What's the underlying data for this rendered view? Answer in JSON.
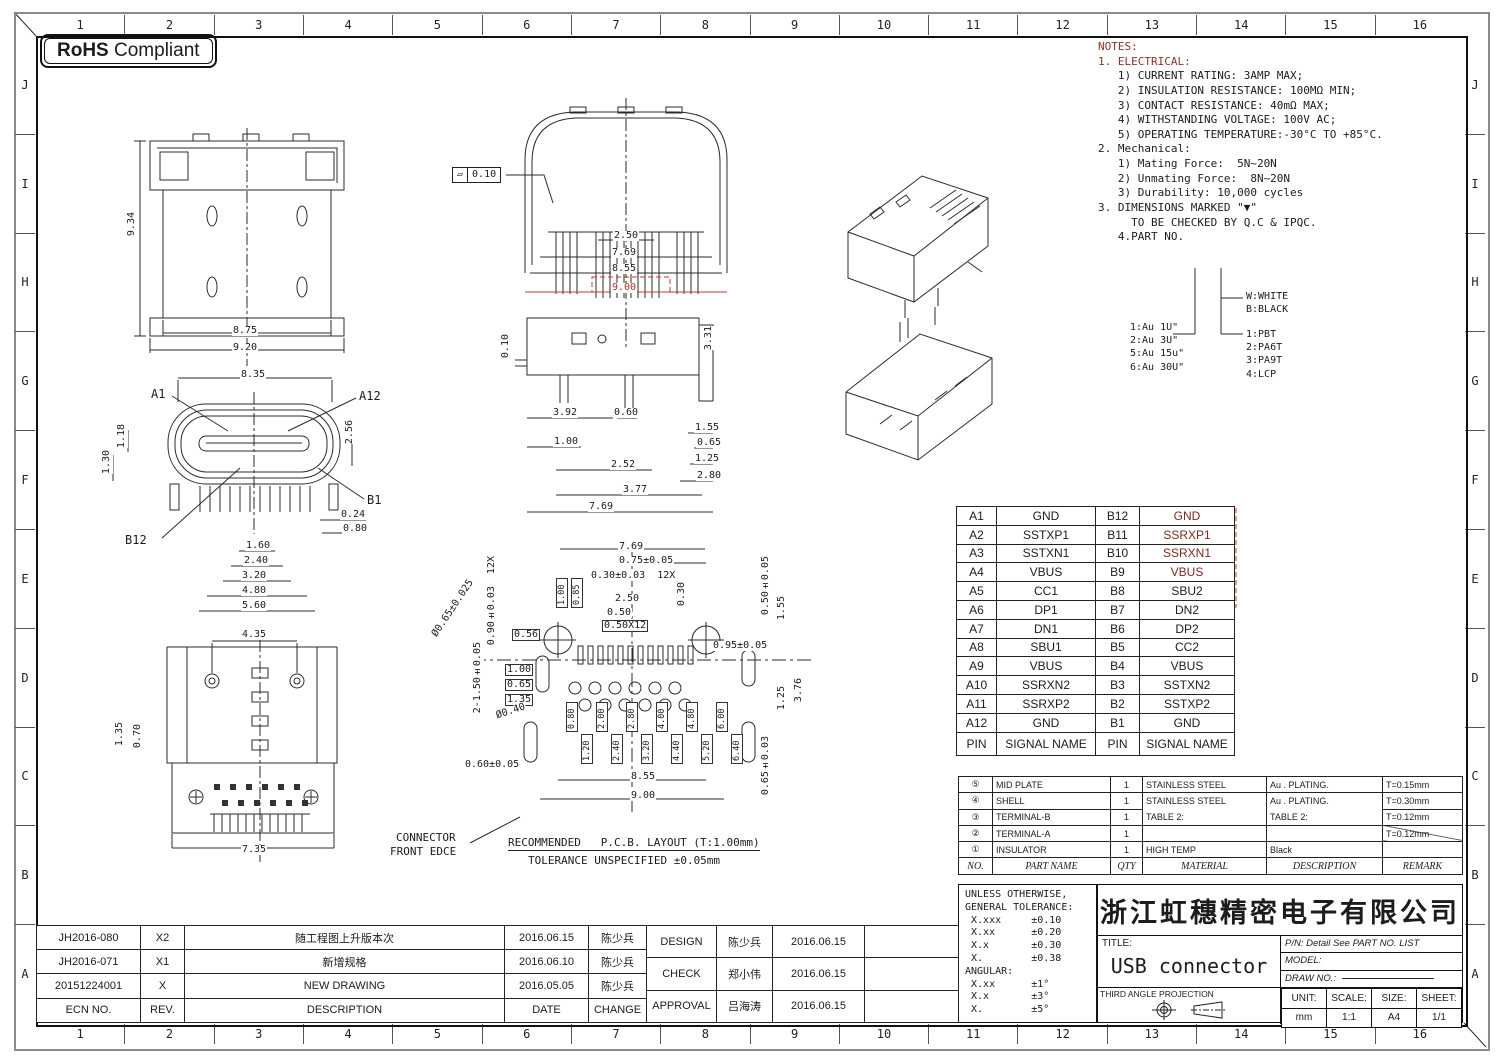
{
  "sheet": {
    "badge_bold": "RoHS",
    "badge_rest": "Compliant",
    "zone_cols": [
      "1",
      "2",
      "3",
      "4",
      "5",
      "6",
      "7",
      "8",
      "9",
      "10",
      "11",
      "12",
      "13",
      "14",
      "15",
      "16"
    ],
    "zone_rows": [
      "J",
      "I",
      "H",
      "G",
      "F",
      "E",
      "D",
      "C",
      "B",
      "A"
    ]
  },
  "notes": {
    "lines": [
      "NOTES:",
      "1. ELECTRICAL:",
      "   1) CURRENT RATING: 3AMP MAX;",
      "   2) INSULATION RESISTANCE: 100MΩ MIN;",
      "   3) CONTACT RESISTANCE: 40mΩ MAX;",
      "   4) WITHSTANDING VOLTAGE: 100V AC;",
      "   5) OPERATING TEMPERATURE:-30°C TO +85°C.",
      "2. Mechanical:",
      "   1) Mating Force:  5N~20N",
      "   2) Unmating Force:  8N~20N",
      "   3) Durability: 10,000 cycles",
      "3. DIMENSIONS MARKED \"▼\"",
      "     TO BE CHECKED BY Q.C & IPQC.",
      "",
      "   4.PART NO."
    ]
  },
  "part_no_legend": {
    "au_options": [
      "1:Au 1U\"",
      "2:Au 3U\"",
      "5:Au 15u\"",
      "6:Au 30U\""
    ],
    "color_options": [
      "W:WHITE",
      "B:BLACK"
    ],
    "material_options": [
      "1:PBT",
      "2:PA6T",
      "3:PA9T",
      "4:LCP"
    ]
  },
  "pin_table": {
    "rows": [
      [
        "A1",
        "GND",
        "B12",
        "GND"
      ],
      [
        "A2",
        "SSTXP1",
        "B11",
        "SSRXP1"
      ],
      [
        "A3",
        "SSTXN1",
        "B10",
        "SSRXN1"
      ],
      [
        "A4",
        "VBUS",
        "B9",
        "VBUS"
      ],
      [
        "A5",
        "CC1",
        "B8",
        "SBU2"
      ],
      [
        "A6",
        "DP1",
        "B7",
        "DN2"
      ],
      [
        "A7",
        "DN1",
        "B6",
        "DP2"
      ],
      [
        "A8",
        "SBU1",
        "B5",
        "CC2"
      ],
      [
        "A9",
        "VBUS",
        "B4",
        "VBUS"
      ],
      [
        "A10",
        "SSRXN2",
        "B3",
        "SSTXN2"
      ],
      [
        "A11",
        "SSRXP2",
        "B2",
        "SSTXP2"
      ],
      [
        "A12",
        "GND",
        "B1",
        "GND"
      ],
      [
        "PIN",
        "SIGNAL NAME",
        "PIN",
        "SIGNAL NAME"
      ]
    ]
  },
  "materials_table": {
    "rows": [
      [
        "⑤",
        "MID PLATE",
        "1",
        "STAINLESS STEEL",
        "Au . PLATING.",
        "T=0.15mm"
      ],
      [
        "④",
        "SHELL",
        "1",
        "STAINLESS STEEL",
        "Au . PLATING.",
        "T=0.30mm"
      ],
      [
        "③",
        "TERMINAL-B",
        "1",
        "TABLE 2:",
        "TABLE 2:",
        "T=0.12mm"
      ],
      [
        "②",
        "TERMINAL-A",
        "1",
        "",
        "",
        "T=0.12mm"
      ],
      [
        "①",
        "INSULATOR",
        "1",
        "HIGH TEMP",
        "Black",
        ""
      ],
      [
        "NO.",
        "PART NAME",
        "QTY",
        "MATERIAL",
        "DESCRIPTION",
        "REMARK"
      ]
    ]
  },
  "tolerance_block": {
    "lines": [
      "UNLESS OTHERWISE,",
      "GENERAL TOLERANCE:",
      " X.xxx     ±0.10",
      " X.xx      ±0.20",
      " X.x       ±0.30",
      " X.        ±0.38",
      "ANGULAR:",
      " X.xx      ±1°",
      " X.x       ±3°",
      " X.        ±5°"
    ]
  },
  "title_block": {
    "company": "浙江虹穗精密电子有限公司",
    "title_label": "TITLE:",
    "title_value": "USB connector",
    "pn": "P/N: Detail See PART NO. LIST",
    "model": "MODEL:",
    "draw_no": "DRAW NO.:",
    "projection": "THIRD ANGLE PROJECTION",
    "unit_label": "UNIT:",
    "unit": "mm",
    "scale_label": "SCALE:",
    "scale": "1:1",
    "size_label": "SIZE:",
    "size": "A4",
    "sheet_label": "SHEET:",
    "sheet": "1/1"
  },
  "revision_table": {
    "rows": [
      [
        "JH2016-080",
        "X2",
        "随工程图上升版本次",
        "2016.06.15",
        "陈少兵"
      ],
      [
        "JH2016-071",
        "X1",
        "新增规格",
        "2016.06.10",
        "陈少兵"
      ],
      [
        "20151224001",
        "X",
        "NEW DRAWING",
        "2016.05.05",
        "陈少兵"
      ],
      [
        "ECN NO.",
        "REV.",
        "DESCRIPTION",
        "DATE",
        "CHANGE"
      ]
    ]
  },
  "approval_table": {
    "rows": [
      [
        "DESIGN",
        "陈少兵",
        "2016.06.15",
        ""
      ],
      [
        "CHECK",
        "郑小伟",
        "2016.06.15",
        ""
      ],
      [
        "APPROVAL",
        "吕海涛",
        "2016.06.15",
        ""
      ]
    ]
  },
  "dims": {
    "top_view": {
      "h": "9.34",
      "w1": "8.75",
      "w2": "9.20"
    },
    "front_view": {
      "w": "8.35",
      "a1": "A1",
      "a12": "A12",
      "b1": "B1",
      "b12": "B12",
      "l1": "1.18",
      "l2": "1.30",
      "r": "2.56",
      "r1": "0.24",
      "r2": "0.80",
      "s1": "1.60",
      "s2": "2.40",
      "s3": "3.20",
      "s4": "4.80",
      "s5": "5.60"
    },
    "bottom_view": {
      "w": "4.35",
      "l1": "1.35",
      "l2": "0.70",
      "b": "7.35"
    },
    "shell_view": {
      "fcf_symbol": "▱",
      "fcf_value": "0.10",
      "d1": "2.50",
      "d2": "7.69",
      "d3": "8.55",
      "d4": "9.00"
    },
    "side_view": {
      "l": "0.10",
      "r": "3.31",
      "d1": "3.92",
      "d2": "0.60",
      "d3": "1.00",
      "d4": "2.52",
      "d5": "3.77",
      "d6": "7.69",
      "r1": "1.55",
      "r2": "0.65",
      "r3": "1.25",
      "r4": "2.80"
    },
    "pcb": {
      "top1": "7.69",
      "top2": "0.75±0.05",
      "top3": "0.30±0.03  12X",
      "d250": "2.50",
      "d050": "0.50",
      "box050": "0.50X12",
      "d030": "0.30",
      "lv1": "0.90±0.03  12X",
      "dia1": "Ø0.65±0.025",
      "b056": "0.56",
      "b100": "1.00",
      "b065": "0.65",
      "b135": "1.35",
      "lv2": "2-1.50±0.05",
      "dia2": "Ø0.40",
      "bl": "0.60±0.05",
      "bot1": "8.55",
      "bot2": "9.00",
      "rv1": "0.50±0.05",
      "rv2": "1.55",
      "r095": "0.95±0.05",
      "rv3": "1.25",
      "rv4": "3.76",
      "rv5": "0.65±0.03",
      "pins_top": [
        "1.00",
        "0.85"
      ],
      "pins": [
        "0.80",
        "1.20",
        "2.00",
        "2.40",
        "2.80",
        "3.20",
        "4.00",
        "4.40",
        "4.80",
        "5.20",
        "6.00",
        "6.40"
      ]
    }
  },
  "captions": {
    "front_edge1": "CONNECTOR",
    "front_edge2": "FRONT EDCE",
    "pcb1": "RECOMMENDED   P.C.B. LAYOUT (T:1.00mm)",
    "pcb2": "TOLERANCE UNSPECIFIED ±0.05mm"
  },
  "colors": {
    "accent_red": "#b03028",
    "line": "#2b2b2b"
  }
}
